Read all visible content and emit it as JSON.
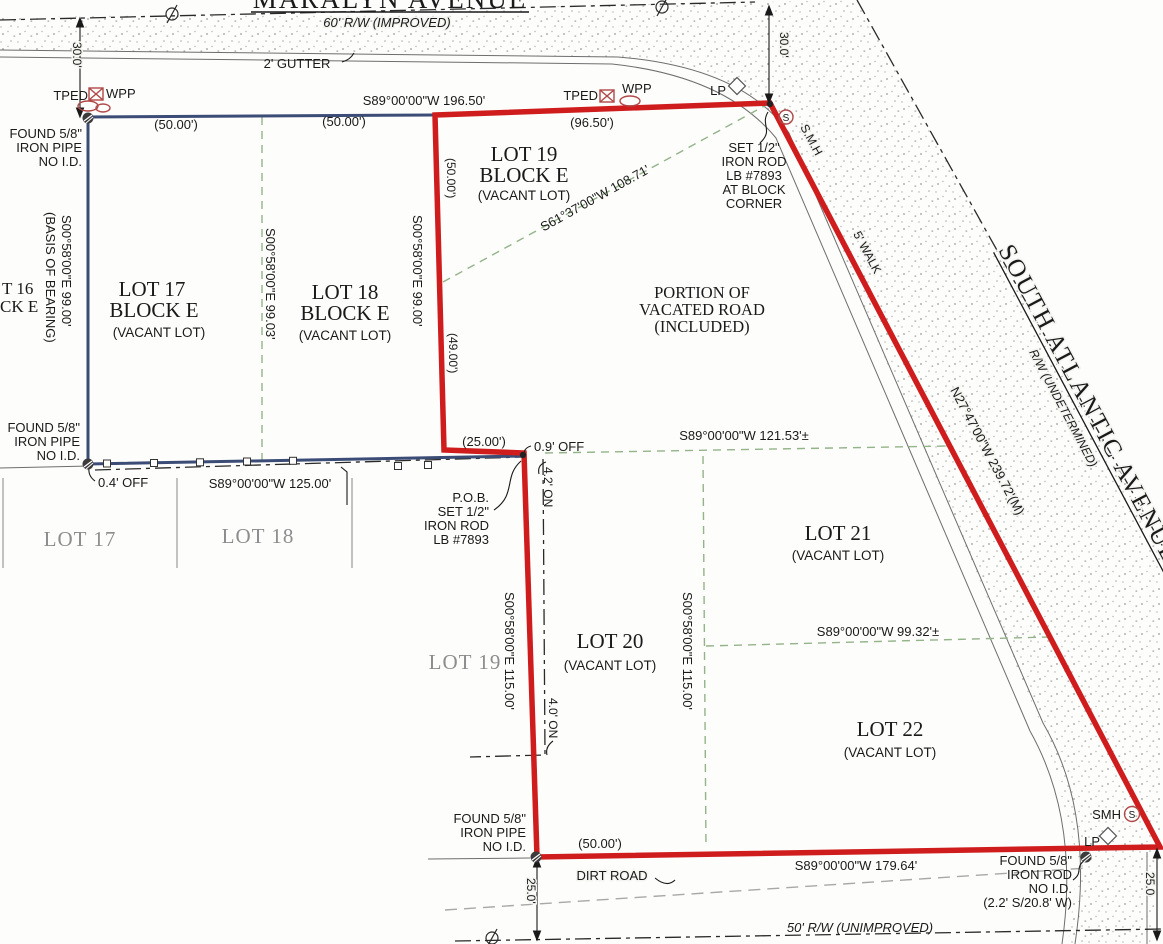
{
  "colors": {
    "boundary": "#cf1d1d",
    "plat": "#3b4c76",
    "lotline": "#93b389",
    "utility": "#b04848",
    "gray": "#9a9a9a"
  },
  "streets": {
    "maralyn": {
      "name": "MARALYN AVENUE",
      "rw": "60' R/W (IMPROVED)",
      "gutter": "2' GUTTER"
    },
    "south_atlantic": {
      "name": "SOUTH ATLANTIC AVENUE",
      "rw": "R/W (UNDETERMINED)",
      "walk": "5' WALK",
      "bearing": "N27°47'00\"W  239.72'(M)"
    },
    "south_road": {
      "rw": "50' R/W (UNIMPROVED)",
      "dirt": "DIRT ROAD"
    }
  },
  "dims": {
    "d30": "30.0'",
    "d25": "25.0'",
    "d25r": "25.0",
    "b196": "S89°00'00\"W  196.50'",
    "p9650": "(96.50')",
    "p50": "(50.00')",
    "p49": "(49.00')",
    "p25": "(25.00')",
    "b12153": "S89°00'00\"W  121.53'±",
    "b9932": "S89°00'00\"W  99.32'±",
    "b125": "S89°00'00\"W  125.00'",
    "b17964": "S89°00'00\"W  179.64'",
    "e9900": "S00°58'00\"E  99.00'",
    "e9903": "S00°58'00\"E  99.03'",
    "e11500": "S00°58'00\"E  115.00'",
    "s61": "S61°37'00\"W  108.71'",
    "basis1": "S00°58'00\"E  99.00'",
    "basis2": "(BASIS OF BEARING)",
    "on42": "4.2' ON",
    "on40": "4.0' ON",
    "off09": "0.9' OFF",
    "off04": "0.4' OFF"
  },
  "lots": {
    "lot16a": "T 16",
    "lot16b": "CK E",
    "lot17": {
      "l1": "LOT 17",
      "l2": "BLOCK E",
      "l3": "(VACANT LOT)"
    },
    "lot18": {
      "l1": "LOT 18",
      "l2": "BLOCK E",
      "l3": "(VACANT LOT)"
    },
    "lot19": {
      "l1": "LOT 19",
      "l2": "BLOCK E",
      "l3": "(VACANT LOT)"
    },
    "lot20": {
      "l1": "LOT 20",
      "l2": "(VACANT LOT)"
    },
    "lot21": {
      "l1": "LOT 21",
      "l2": "(VACANT LOT)"
    },
    "lot22": {
      "l1": "LOT 22",
      "l2": "(VACANT LOT)"
    },
    "portion": {
      "l1": "PORTION OF",
      "l2": "VACATED ROAD",
      "l3": "(INCLUDED)"
    },
    "gray17": "LOT 17",
    "gray18": "LOT 18",
    "gray19": "LOT 19"
  },
  "monuments": {
    "found_pipe": {
      "l1": "FOUND 5/8\"",
      "l2": "IRON PIPE",
      "l3": "NO I.D."
    },
    "found_rod": {
      "l1": "FOUND 5/8\"",
      "l2": "IRON ROD",
      "l3": "NO I.D.",
      "l4": "(2.2' S/20.8' W)"
    },
    "set_rod_corner": {
      "l1": "SET 1/2\"",
      "l2": "IRON ROD",
      "l3": "LB #7893",
      "l4": "AT BLOCK",
      "l5": "CORNER"
    },
    "pob": {
      "l1": "P.O.B.",
      "l2": "SET 1/2\"",
      "l3": "IRON ROD",
      "l4": "LB #7893"
    }
  },
  "utilities": {
    "tped": "TPED",
    "wpp": "WPP",
    "lp": "LP",
    "smh_top": "S.M.H",
    "smh_bottom": "SMH",
    "s": "S"
  }
}
